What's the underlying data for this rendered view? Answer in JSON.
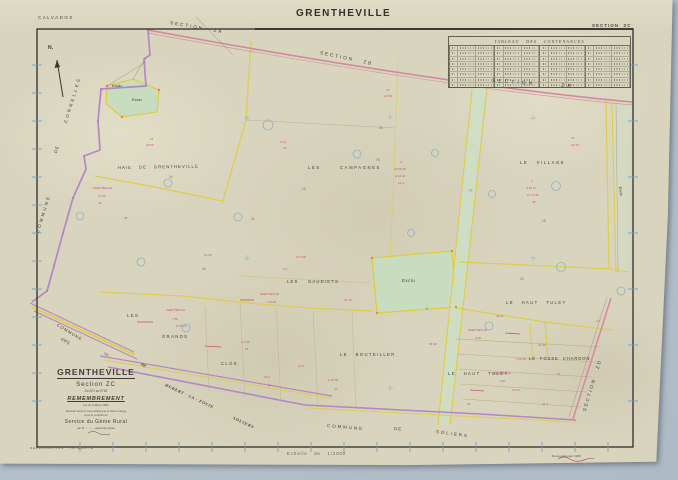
{
  "colors": {
    "paper": "#d9d4bd",
    "scan_background": "#b6c2cb",
    "frame_black": "#2e2c28",
    "section_road_pink": "#d4879f",
    "commune_boundary_purple": "#b287c4",
    "parcel_line_yellow": "#dfcc42",
    "excluded_green": "#c8dcc0",
    "parcel_number_red": "#cf4f68",
    "survey_blue": "#7fa8c9"
  },
  "margins": {
    "department": "CALVADOS",
    "sheet_title": "GRENTHEVILLE",
    "sheet_section": "SECTION  ZC",
    "scale_note": "Echelle   de   1/2000",
    "reproduction_note": "REPRODUCTION    INTERDITE",
    "revision_note_line1": "Renouvelé pour 1966",
    "revision_note_line2": "GRENTHEVILLE  ZC  1/2000"
  },
  "contenance_table": {
    "title": "TABLEAU   DES   CONTENANCES",
    "columns": 12,
    "rows": 8
  },
  "title_block": {
    "commune": "GRENTHEVILLE",
    "section": "Section  ZC",
    "numbers_range": "Du N°1 au N°61",
    "operation": "REMEMBREMENT",
    "law": "Loi du 9 Mars 1941",
    "note_line1": "Exécuté dans la zone limitée par le liseré orange",
    "note_line2": "sous le contrôle du",
    "service": "Service du Génie Rural",
    "signature": "par M. .........., géomètre agréé"
  },
  "compass": {
    "label": "N."
  },
  "map": {
    "labels": [
      {
        "t": "SECTION   ZA",
        "x": 170,
        "y": 21,
        "fs": 4.6,
        "ls": 2,
        "rot": 10
      },
      {
        "t": "SECTION   ZB",
        "x": 320,
        "y": 51,
        "fs": 4.6,
        "ls": 2,
        "rot": 12
      },
      {
        "t": "SECTION      ZB",
        "x": 492,
        "y": 79,
        "fs": 5,
        "ls": 3,
        "rot": 4
      },
      {
        "t": "SECTION   ZD",
        "x": 585,
        "y": 409,
        "fs": 4.6,
        "ls": 2,
        "rot": -73
      },
      {
        "t": "HAIE   DE   GRENTHEVILLE",
        "x": 118,
        "y": 166,
        "fs": 4.2,
        "ls": 1.1,
        "rot": -1
      },
      {
        "t": "LES       CAMPAGNES",
        "x": 308,
        "y": 166,
        "fs": 4.2,
        "ls": 1.6
      },
      {
        "t": "LE   VILLAGE",
        "x": 520,
        "y": 161,
        "fs": 4.2,
        "ls": 1.6
      },
      {
        "t": "Exclu",
        "x": 112,
        "y": 84,
        "fs": 4
      },
      {
        "t": "Exclu",
        "x": 132,
        "y": 98,
        "fs": 4
      },
      {
        "t": "Exclu",
        "x": 402,
        "y": 279,
        "fs": 4.4,
        "ls": 0.5
      },
      {
        "t": "Exclu",
        "x": 619,
        "y": 185,
        "fs": 3.8,
        "rot": 82
      },
      {
        "t": "LES    GAUDIETS",
        "x": 287,
        "y": 280,
        "fs": 4.2,
        "ls": 1.2
      },
      {
        "t": "LE   HAUT   TULEY",
        "x": 506,
        "y": 301,
        "fs": 4.2,
        "ls": 1.4
      },
      {
        "t": "LE  FOSSE  CHARDON",
        "x": 529,
        "y": 357,
        "fs": 4.2,
        "ls": 0.9
      },
      {
        "t": "LE   HAUT   TULEY",
        "x": 448,
        "y": 372,
        "fs": 4.2,
        "ls": 1.4
      },
      {
        "t": "LE   BOUTEILLER",
        "x": 340,
        "y": 353,
        "fs": 4.2,
        "ls": 1.4
      },
      {
        "t": "LES",
        "x": 127,
        "y": 314,
        "fs": 4.2,
        "ls": 1.4
      },
      {
        "t": "GRANDS",
        "x": 162,
        "y": 335,
        "fs": 4.2,
        "ls": 1.4
      },
      {
        "t": "CLOS",
        "x": 221,
        "y": 362,
        "fs": 4.2,
        "ls": 1.4
      },
      {
        "t": "CORNELLES",
        "x": 66,
        "y": 121,
        "fs": 4.4,
        "ls": 2.4,
        "rot": -73
      },
      {
        "t": "DE",
        "x": 56,
        "y": 151,
        "fs": 4.4,
        "ls": 1,
        "rot": -73
      },
      {
        "t": "COMMUNE",
        "x": 38,
        "y": 231,
        "fs": 4.4,
        "ls": 2.4,
        "rot": -73
      },
      {
        "t": "COMMUNE",
        "x": 57,
        "y": 323,
        "fs": 4.2,
        "ls": 1,
        "rot": 31
      },
      {
        "t": "d'IFS",
        "x": 61,
        "y": 337,
        "fs": 4.2,
        "rot": 31
      },
      {
        "t": "Cin",
        "x": 104,
        "y": 352,
        "fs": 3.2,
        "rot": 31
      },
      {
        "t": "DE",
        "x": 141,
        "y": 362,
        "fs": 4,
        "rot": 30,
        "w": 700,
        "i": 1,
        "f": "serif"
      },
      {
        "t": "HUBERT - LA - FOLIE",
        "x": 165,
        "y": 383,
        "fs": 4.2,
        "ls": 0.6,
        "rot": 25,
        "w": 700,
        "i": 1,
        "f": "serif"
      },
      {
        "t": "SOLIERS",
        "x": 233,
        "y": 416,
        "fs": 4.2,
        "ls": 0.8,
        "rot": 25,
        "w": 700,
        "i": 1,
        "f": "serif"
      },
      {
        "t": "COMMUNE",
        "x": 327,
        "y": 424,
        "fs": 4.4,
        "ls": 2,
        "rot": 5
      },
      {
        "t": "DE",
        "x": 394,
        "y": 427,
        "fs": 4.4,
        "ls": 1,
        "rot": 5
      },
      {
        "t": "SOLIERS",
        "x": 436,
        "y": 430,
        "fs": 4.4,
        "ls": 2,
        "rot": 8
      }
    ],
    "parcel_numbers_red": [
      {
        "t": "21",
        "x": 150,
        "y": 138
      },
      {
        "t": "29 50",
        "x": 146,
        "y": 144
      },
      {
        "t": "GRENTHEVILLE",
        "x": 93,
        "y": 188,
        "fs": 2.5
      },
      {
        "t": "17 30",
        "x": 98,
        "y": 195
      },
      {
        "t": "32",
        "x": 98,
        "y": 202
      },
      {
        "t": "17 A",
        "x": 280,
        "y": 141
      },
      {
        "t": "23",
        "x": 283,
        "y": 147
      },
      {
        "t": "27",
        "x": 386,
        "y": 89
      },
      {
        "t": "20 50",
        "x": 384,
        "y": 95
      },
      {
        "t": "4",
        "x": 400,
        "y": 161
      },
      {
        "t": "10 20 08",
        "x": 394,
        "y": 168
      },
      {
        "t": "A 16 32",
        "x": 395,
        "y": 175
      },
      {
        "t": "12 a",
        "x": 398,
        "y": 182
      },
      {
        "t": "4",
        "x": 531,
        "y": 180
      },
      {
        "t": "A 20 12",
        "x": 526,
        "y": 187
      },
      {
        "t": "17 10 48",
        "x": 527,
        "y": 194
      },
      {
        "t": "40",
        "x": 532,
        "y": 201
      },
      {
        "t": "75",
        "x": 571,
        "y": 137
      },
      {
        "t": "20 40",
        "x": 571,
        "y": 144
      },
      {
        "t": "27 3 00",
        "x": 296,
        "y": 256
      },
      {
        "t": "2 A",
        "x": 283,
        "y": 268
      },
      {
        "t": "GRENTHEVILLE",
        "x": 260,
        "y": 294,
        "fs": 2.5
      },
      {
        "t": "7 10 60",
        "x": 266,
        "y": 301
      },
      {
        "t": "GRENTHEVILLE",
        "x": 166,
        "y": 310,
        "fs": 2.5
      },
      {
        "t": "7 50",
        "x": 172,
        "y": 318
      },
      {
        "t": "P 10 23",
        "x": 176,
        "y": 325
      },
      {
        "t": "A 2 50",
        "x": 241,
        "y": 341
      },
      {
        "t": "25",
        "x": 245,
        "y": 348
      },
      {
        "t": "12 A",
        "x": 298,
        "y": 365
      },
      {
        "t": "25 A",
        "x": 264,
        "y": 376
      },
      {
        "t": "12",
        "x": 268,
        "y": 384
      },
      {
        "t": "A 26 50",
        "x": 328,
        "y": 379
      },
      {
        "t": "47",
        "x": 334,
        "y": 388
      },
      {
        "t": "56 40",
        "x": 429,
        "y": 343
      },
      {
        "t": "49 12",
        "x": 496,
        "y": 315
      },
      {
        "t": "GRENTHEVILLE",
        "x": 468,
        "y": 330,
        "fs": 2.5
      },
      {
        "t": "9 20",
        "x": 475,
        "y": 337
      },
      {
        "t": "25 40",
        "x": 538,
        "y": 344
      },
      {
        "t": "7 20 30",
        "x": 516,
        "y": 358
      },
      {
        "t": "21",
        "x": 557,
        "y": 373
      },
      {
        "t": "GRENTHEVILLE",
        "x": 492,
        "y": 373,
        "fs": 2.5
      },
      {
        "t": "4 30",
        "x": 499,
        "y": 380
      },
      {
        "t": "12 50",
        "x": 512,
        "y": 389
      },
      {
        "t": "31 A",
        "x": 542,
        "y": 403
      },
      {
        "t": "26",
        "x": 467,
        "y": 403
      },
      {
        "t": "4 a",
        "x": 596,
        "y": 320,
        "fs": 2.8
      },
      {
        "t": "21 10",
        "x": 344,
        "y": 299
      },
      {
        "t": "14 50",
        "x": 204,
        "y": 254
      },
      {
        "t": "36",
        "x": 124,
        "y": 217
      }
    ],
    "small_numbers": [
      {
        "t": "14",
        "x": 169,
        "y": 176
      },
      {
        "t": "75",
        "x": 376,
        "y": 159
      },
      {
        "t": "77",
        "x": 469,
        "y": 190
      },
      {
        "t": "11",
        "x": 251,
        "y": 218
      },
      {
        "t": "15",
        "x": 542,
        "y": 220
      },
      {
        "t": "13",
        "x": 302,
        "y": 188
      },
      {
        "t": "9",
        "x": 426,
        "y": 308
      },
      {
        "t": "16",
        "x": 202,
        "y": 268
      },
      {
        "t": "12",
        "x": 520,
        "y": 278
      },
      {
        "t": "25",
        "x": 379,
        "y": 127
      }
    ]
  }
}
